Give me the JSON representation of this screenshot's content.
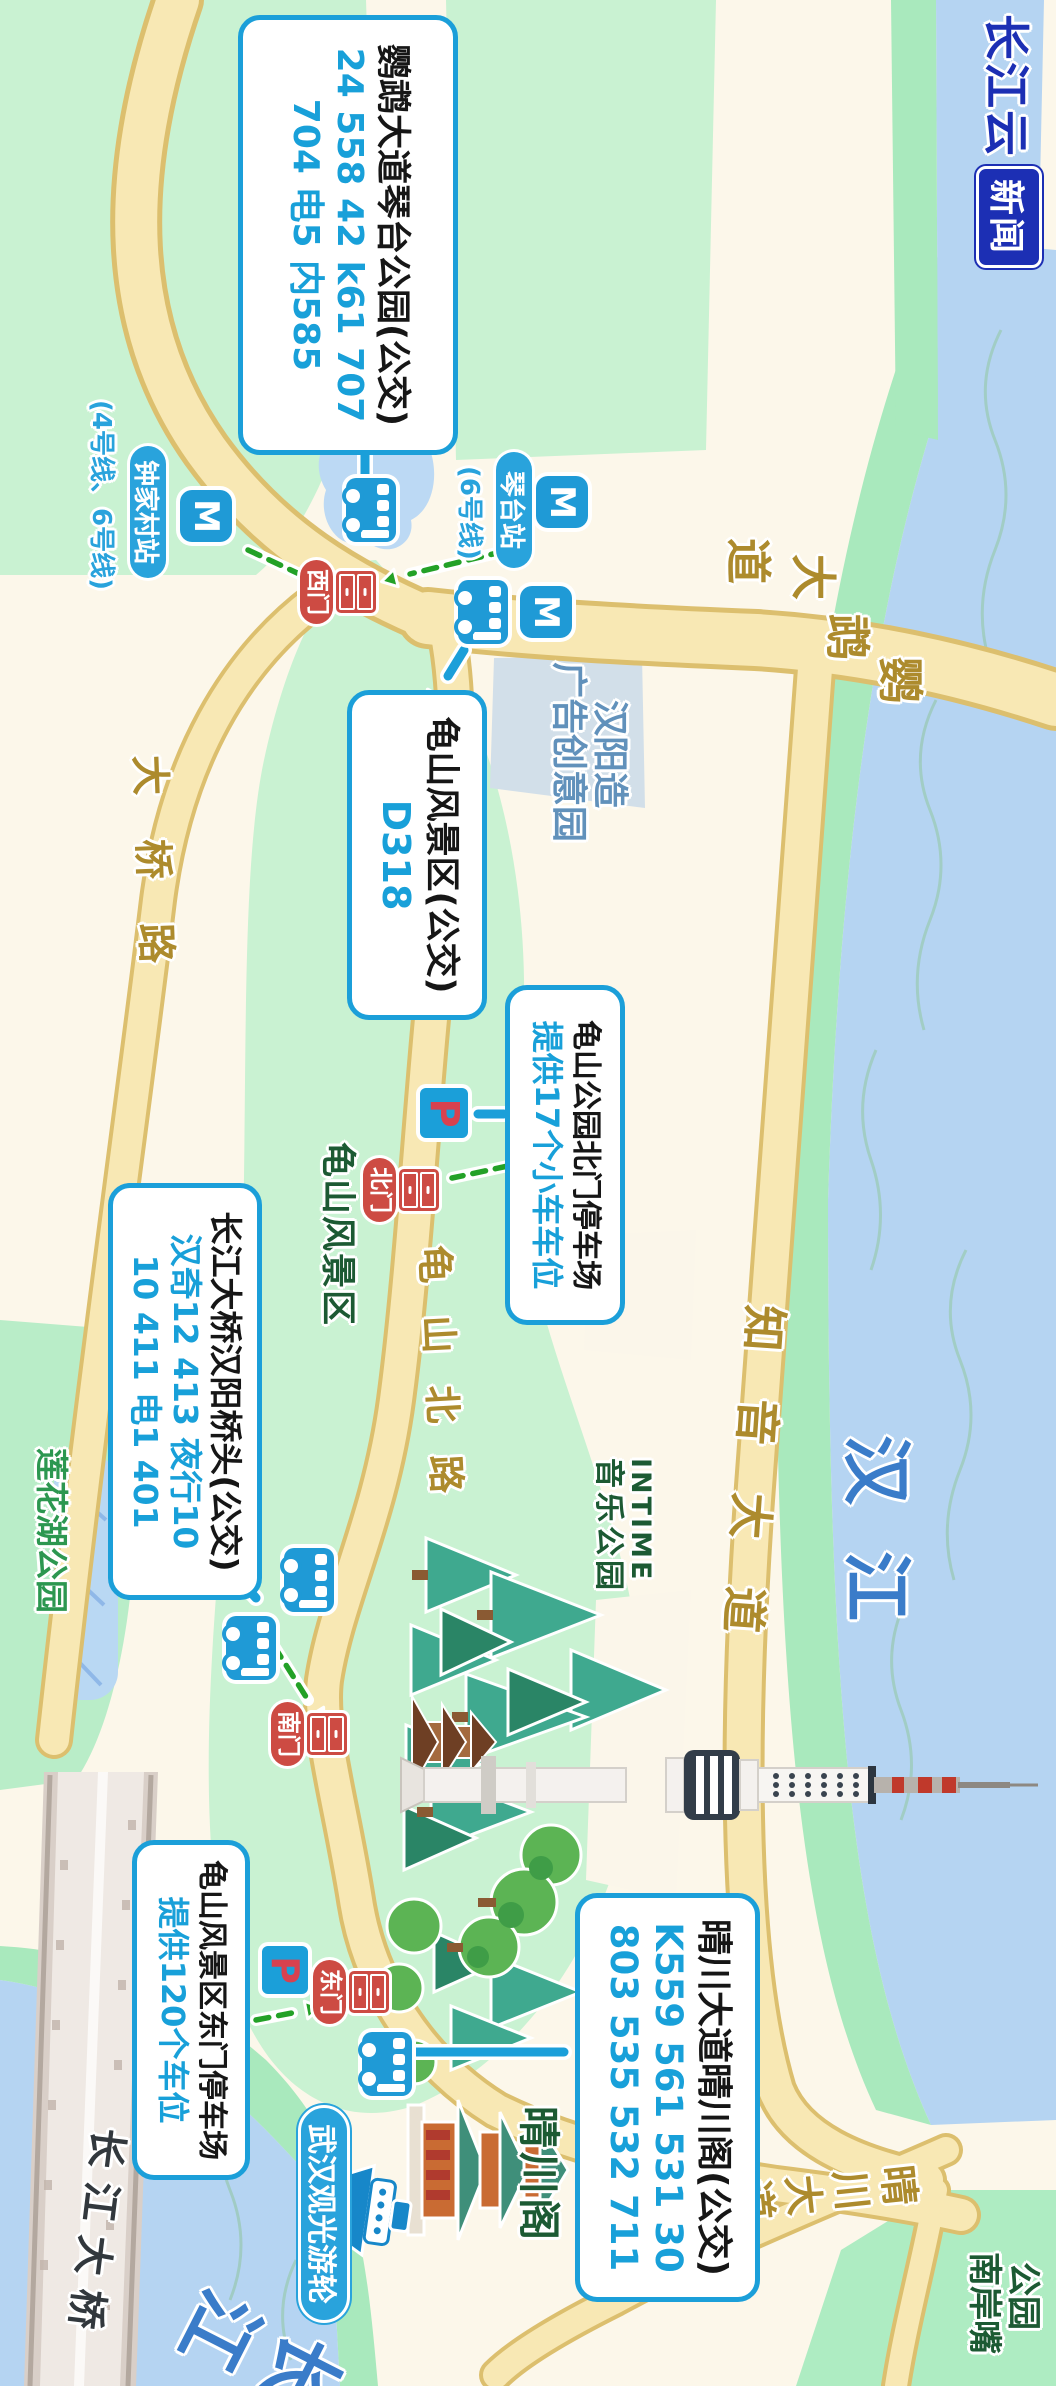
{
  "logo": {
    "text": "长江云",
    "boxed": "新闻"
  },
  "callouts": {
    "qintai_park": {
      "title": "鹦鹉大道琴台公园(公交)",
      "line1": "24 558 42 k61 707",
      "line2": "704 电5 内585"
    },
    "guishan": {
      "title": "龟山风景区(公交)",
      "line1": "D318"
    },
    "bridgehead": {
      "title": "长江大桥汉阳桥头(公交)",
      "line1": "汉奇12 413 夜行10",
      "line2": "10 411 电1 401"
    },
    "qingchuan": {
      "title": "晴川大道晴川阁(公交)",
      "line1": "K559 561 531 30",
      "line2": "803 535 532 711"
    },
    "east_parking": {
      "title": "龟山风景区东门停车场",
      "line1": "提供120个车位"
    },
    "north_parking": {
      "title": "龟山公园北门停车场",
      "line1": "提供17个小车车位"
    }
  },
  "stations": {
    "zhongjiacun": {
      "name": "钟家村站",
      "lines": "(4号线、6号线)"
    },
    "qintai": {
      "name": "琴台站",
      "lines": "(6号线)"
    }
  },
  "gates": {
    "west": "西门",
    "north": "北门",
    "south": "南门",
    "east": "东门"
  },
  "roads": {
    "yingwu": [
      "鹦",
      "鹉",
      "大",
      "道"
    ],
    "zhiyin": "知音大道",
    "guishanbei": "龟山北路",
    "daqiao": "大桥路",
    "qingchuan": "晴川大道",
    "bridge": "长江大桥"
  },
  "waters": {
    "hanjiang": "汉江",
    "changjiang": "长江"
  },
  "areas": {
    "scenic": "龟山风景区",
    "intime_line1": "INTIME",
    "intime_line2": "音乐公园",
    "hanyangzao_line1": "汉阳造",
    "hanyangzao_line2": "广告创意园",
    "lianhua": "莲花湖公园",
    "qingchuange": "晴川阁",
    "nanan_line1": "公园",
    "nanan_line2": "南岸嘴",
    "cruise": "武汉观光游轮"
  },
  "markers": {
    "parking": "P",
    "metro": "M"
  },
  "colors": {
    "accent_blue": "#1b9fd9",
    "gate_red": "#cd4b43",
    "road_label_gold": "#ad8b2d",
    "water_label_blue": "#3a7cc9",
    "area_label_green": "#1c5a33",
    "logo_blue": "#1c2fb4"
  }
}
